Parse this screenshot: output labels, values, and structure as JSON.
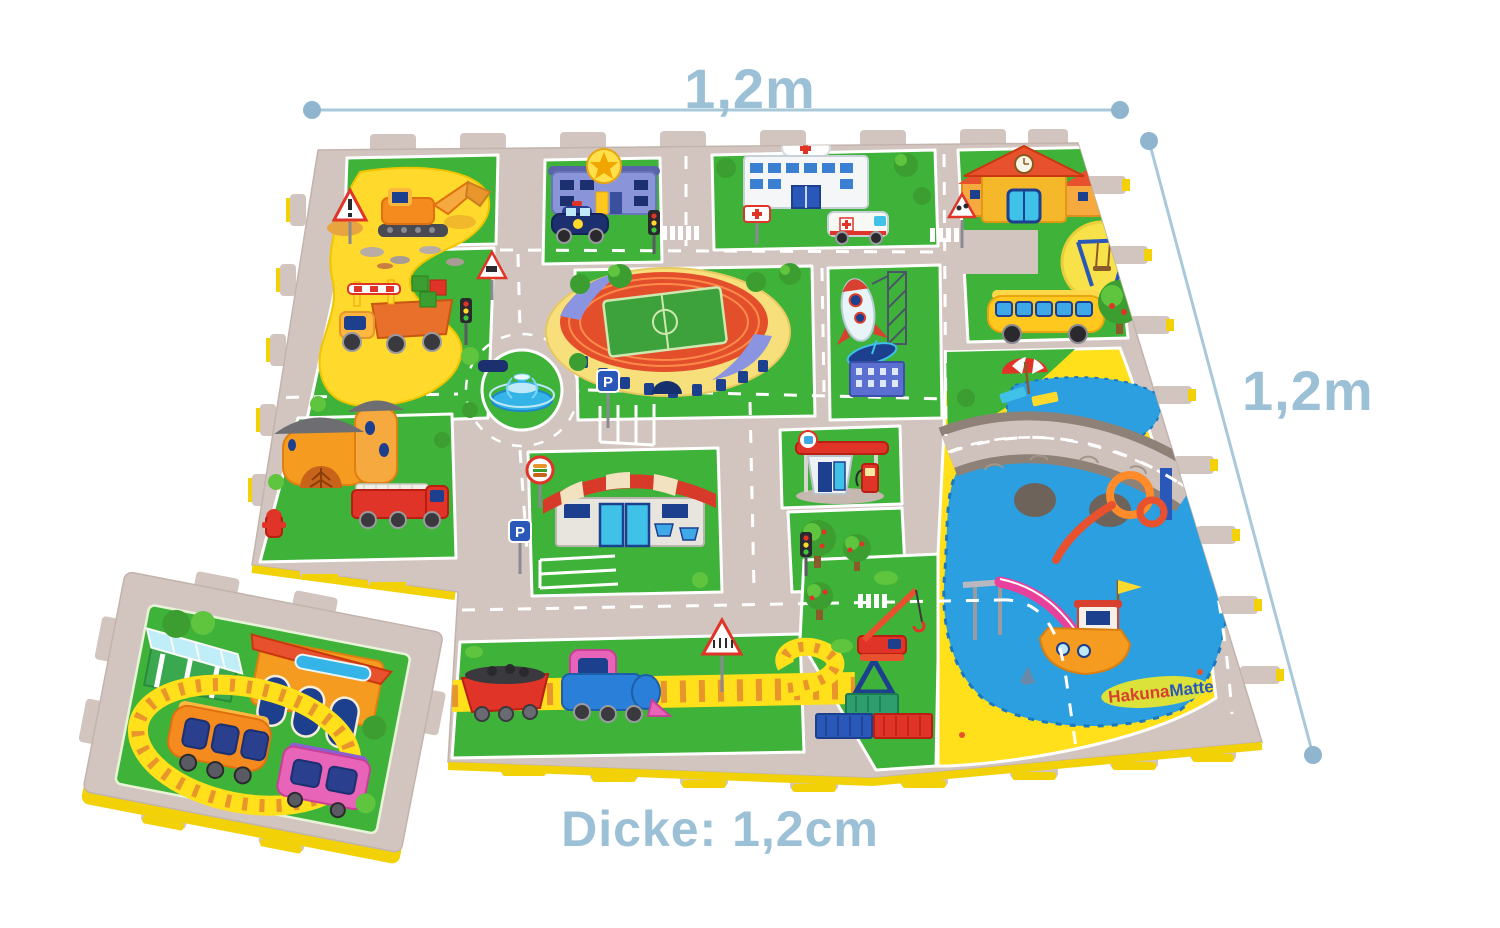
{
  "annotations": {
    "width_label": "1,2m",
    "height_label": "1,2m",
    "thickness_label": "Dicke: 1,2cm"
  },
  "mat": {
    "brand_logo": {
      "part1": "Hakuna",
      "part2": "Matte"
    },
    "parking_sign_letter": "P",
    "scene_elements": [
      "construction-site",
      "excavator",
      "dump-truck",
      "warning-sign",
      "roadworks-sign",
      "police-station",
      "police-car",
      "hospital",
      "ambulance",
      "hospital-sign",
      "school",
      "school-crossing-sign",
      "playground-swing",
      "school-bus",
      "apple-tree",
      "stadium",
      "rocket",
      "launch-tower",
      "satellite-dish",
      "apartment-building",
      "fountain-roundabout",
      "parking-area",
      "parking-sign",
      "traffic-light",
      "crosswalk",
      "fire-house",
      "fire-truck",
      "fire-hydrant",
      "awning-shop",
      "burger-sign",
      "gas-station",
      "stone-bridge",
      "upper-lake",
      "big-lake",
      "beach-umbrella",
      "water-slide",
      "spiral-slide",
      "boat",
      "shark-fin",
      "port-crane",
      "shipping-containers",
      "railway-track",
      "coal-wagon",
      "locomotive",
      "railway-crossing-sign",
      "train-station-tile",
      "train-station",
      "station-canopy",
      "toy-train",
      "brand-logo"
    ]
  },
  "colors": {
    "annotation_text": "#9cc0d6",
    "dimension_line": "#a9c8da",
    "dimension_dot": "#8fb6ce",
    "mat_surface_road": "#d2c5bf",
    "mat_green": "#3fb239",
    "construction_yellow": "#ffd92b",
    "water_blue": "#2b9fe0",
    "sand_yellow": "#ffe01a",
    "foam_edge_yellow": "#f2d206"
  }
}
